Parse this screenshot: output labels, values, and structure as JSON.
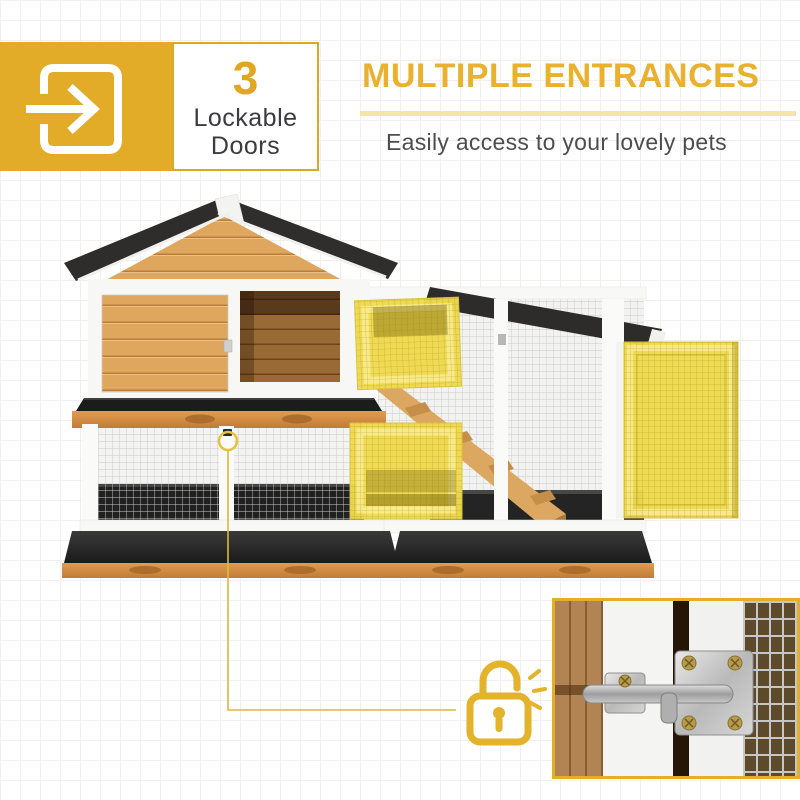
{
  "badge": {
    "icon": "enter-arrow-icon",
    "count": "3",
    "label_line1": "Lockable",
    "label_line2": "Doors"
  },
  "feature": {
    "title": "MULTIPLE ENTRANCES",
    "subtitle": "Easily access to your lovely pets"
  },
  "callout": {
    "icon": "unlocked-padlock-icon"
  },
  "colors": {
    "accent_gold": "#E2AC28",
    "heading_gold": "#E9B12E",
    "underline_pale": "#F6E5A7",
    "door_highlight_yellow": "#F0DA4F",
    "text_dark": "#3B3B41",
    "subtitle_gray": "#4D4D4D",
    "roof_black": "#2F2D2B",
    "wood": "#DFA65E"
  }
}
